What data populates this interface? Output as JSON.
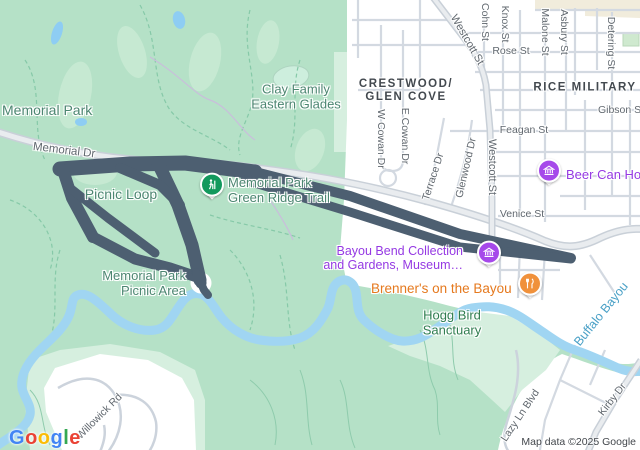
{
  "app": "map-viewer",
  "labels": {
    "memorial_park": "Memorial Park",
    "clay_family_l1": "Clay Family",
    "clay_family_l2": "Eastern Glades",
    "picnic_loop": "Picnic Loop",
    "green_ridge_l1": "Memorial Park",
    "green_ridge_l2": "Green Ridge Trail",
    "picnic_area_l1": "Memorial Park",
    "picnic_area_l2": "Picnic Area",
    "crestwood_l1": "CRESTWOOD/",
    "crestwood_l2": "GLEN COVE",
    "rice_military": "RICE MILITARY",
    "hogg_l1": "Hogg Bird",
    "hogg_l2": "Sanctuary",
    "bayou_bend_l1": "Bayou Bend Collection",
    "bayou_bend_l2": "and Gardens, Museum…",
    "brenners": "Brenner's on the Bayou",
    "beer_can": "Beer Can House",
    "buffalo_bayou": "Buffalo Bayou",
    "memorial_dr": "Memorial Dr",
    "westcott_diag": "Westcott St",
    "westcott_vert": "Westcott St",
    "cohn_st": "Cohn St",
    "knox_st": "Knox St",
    "rose_st": "Rose St",
    "malone_st": "Malone St",
    "asbury_st": "Asbury St",
    "detering_st": "Detering St",
    "gibson_st": "Gibson St",
    "feagan_st": "Feagan St",
    "venice_st": "Venice St",
    "w_cowan": "W Cowan Dr",
    "e_cowan": "E Cowan Dr",
    "terrace": "Terrace Dr",
    "glenwood": "Glenwood Dr",
    "willowick": "Willowick Rd",
    "lazy_ln": "Lazy Ln Blvd",
    "kirby": "Kirby Dr"
  },
  "markers": {
    "green_ridge": {
      "icon": "hiker-icon",
      "color": "#13995d"
    },
    "bayou_bend": {
      "icon": "museum-icon",
      "color": "#a649ea"
    },
    "beer_can": {
      "icon": "museum-icon",
      "color": "#a649ea"
    },
    "brenners": {
      "icon": "restaurant-icon",
      "color": "#f0913b"
    },
    "picnic_area": {
      "icon": "dot-icon",
      "color": "#4a5d70"
    }
  },
  "route_overlay": {
    "color": "#4d5f71",
    "description": "dark highlighted route/track over Memorial Dr and Picnic Loop"
  },
  "colors": {
    "park_green": "#b5e1c7",
    "light_green": "#c7e9d3",
    "pale_green": "#d6efdf",
    "urban_white": "#ffffff",
    "water_blue": "#a0d5f2",
    "beige": "#f1ecdc",
    "road_gray": "#c9d0d8",
    "poi_purple": "#9539e3",
    "poi_orange": "#e5791e"
  },
  "logo": {
    "l0": "G",
    "l1": "o",
    "l2": "o",
    "l3": "g",
    "l4": "l",
    "l5": "e"
  },
  "attribution": "Map data ©2025 Google"
}
